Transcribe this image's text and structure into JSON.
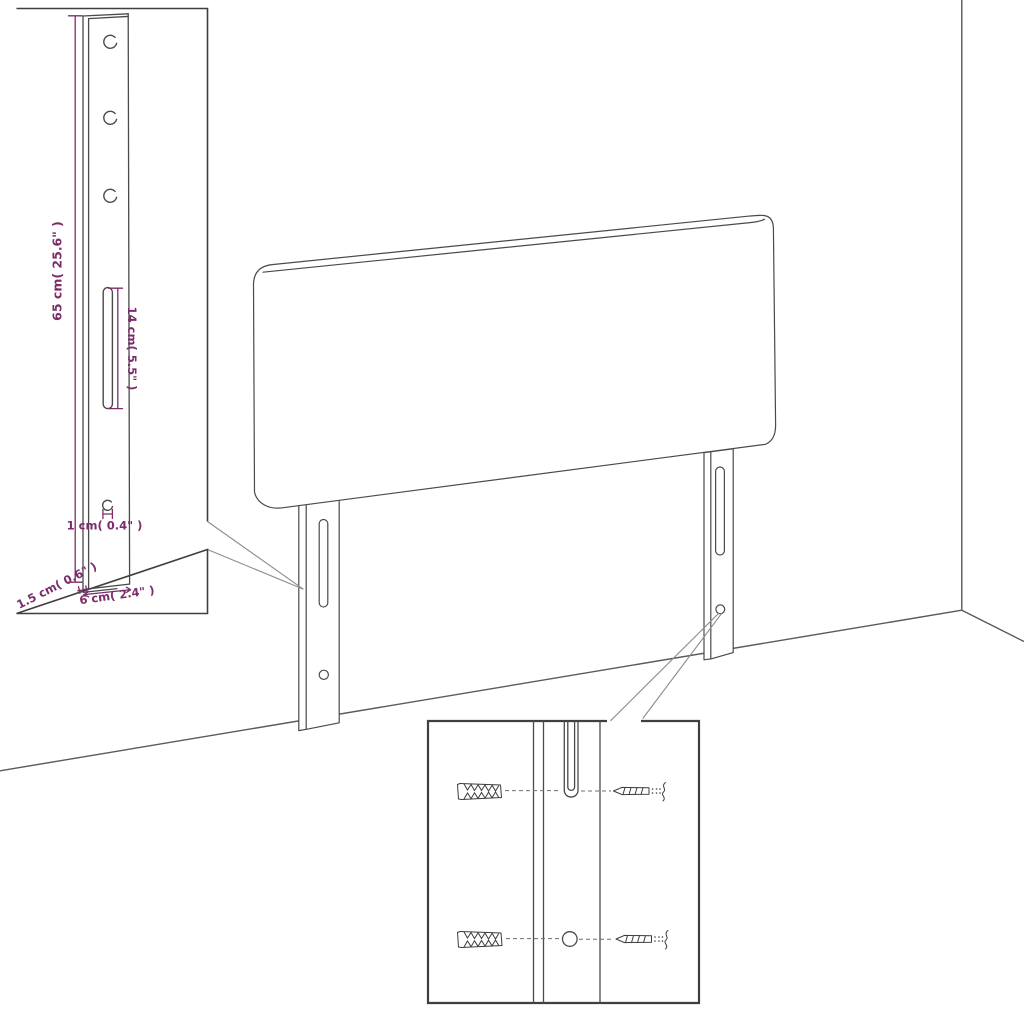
{
  "colors": {
    "background": "#ffffff",
    "line": "#4a4a4a",
    "dimension": "#7b2d6b",
    "callout": "#8c8c8c",
    "inset_border": "#3f3f3f"
  },
  "leg_detail_inset": {
    "dim_length_label": "65 cm( 25.6\" )",
    "dim_slot_label": "14 cm( 5.5\" )",
    "dim_hole_label": "1 cm( 0.4\" )",
    "dim_thickness_label": "1.5 cm( 0.6\" )",
    "dim_width_label": "6 cm( 2.4\" )"
  },
  "hardware_inset": {
    "left_icon": "wall-plug-icon",
    "right_icon": "screw-icon"
  }
}
